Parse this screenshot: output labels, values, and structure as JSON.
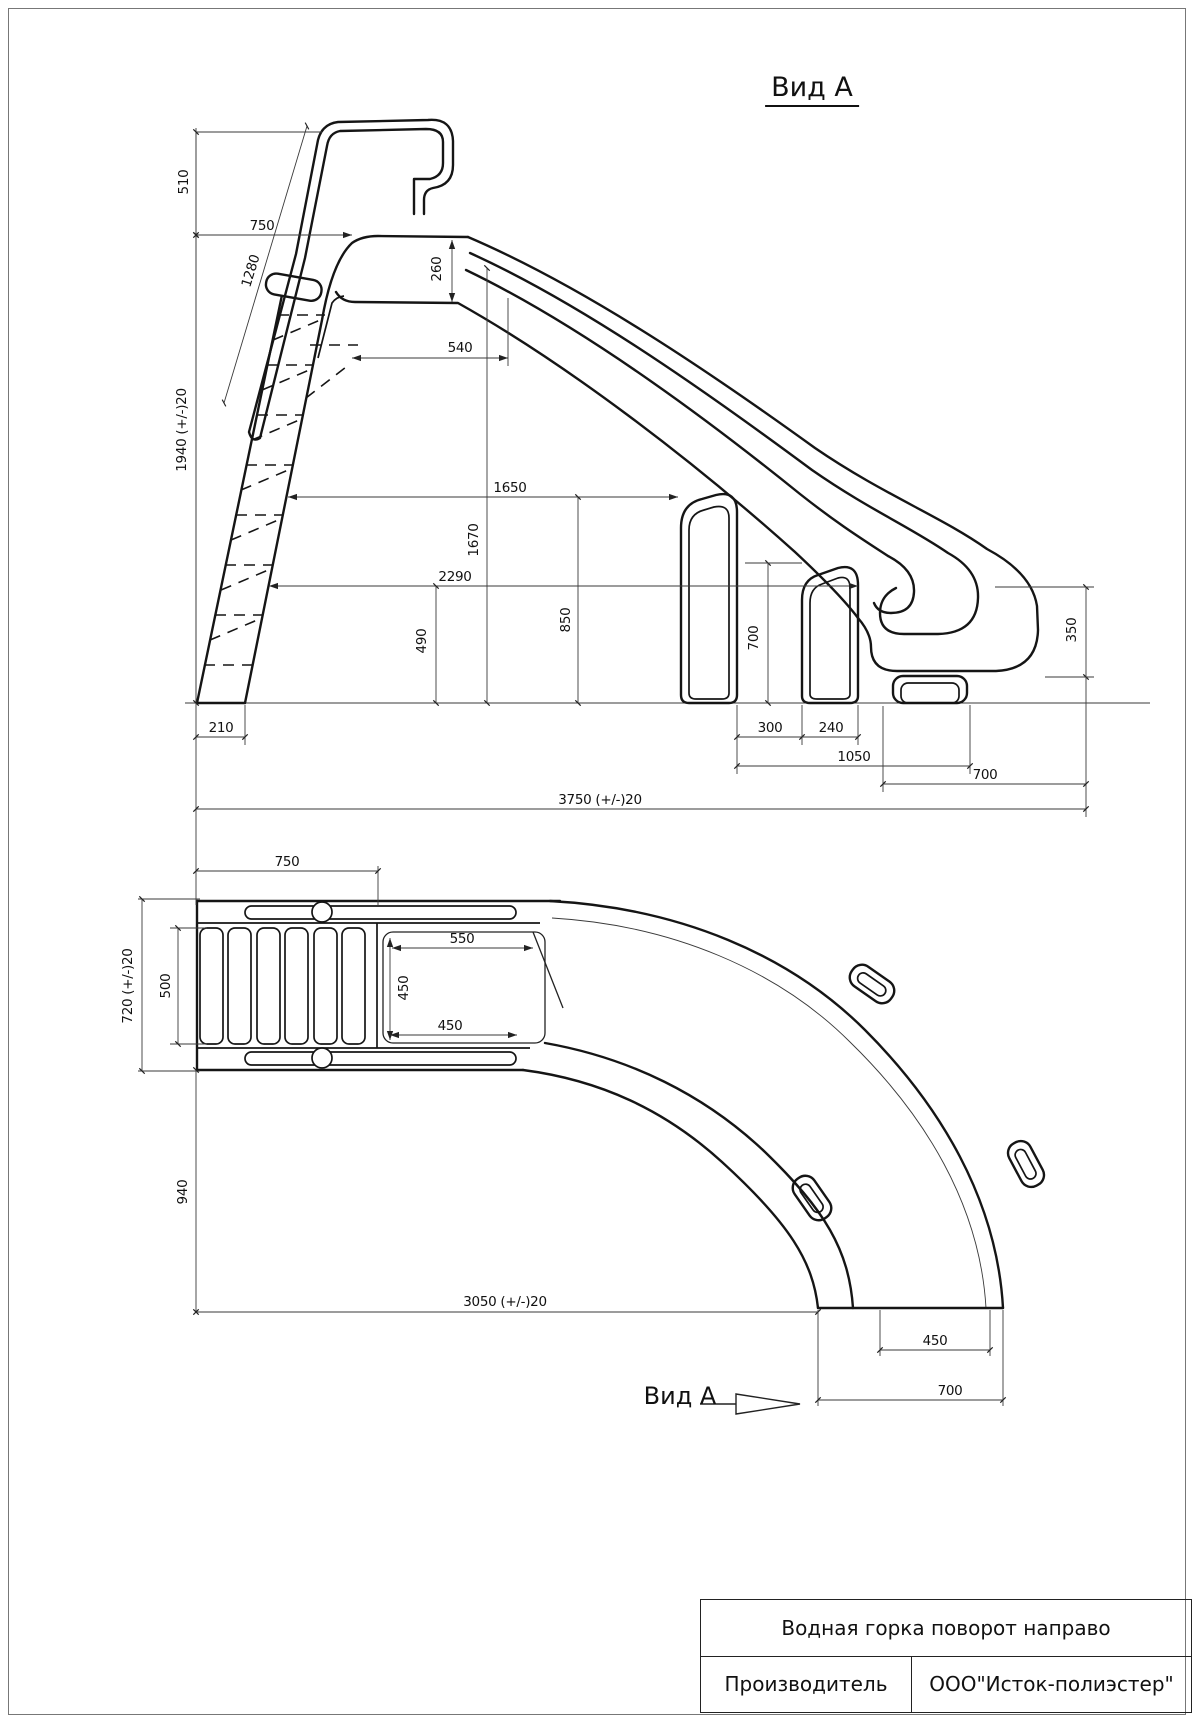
{
  "titles": {
    "view_a_top": "Вид А",
    "view_a_bottom": "Вид А"
  },
  "side_view": {
    "dims": {
      "d510": "510",
      "d750": "750",
      "d1280": "1280",
      "d1940": "1940 (+/-)20",
      "d260": "260",
      "d540": "540",
      "d1650": "1650",
      "d1670": "1670",
      "d2290": "2290",
      "d850": "850",
      "d490": "490",
      "d700_leg": "700",
      "d350": "350",
      "d210": "210",
      "d300": "300",
      "d240": "240",
      "d1050": "1050",
      "d700_bottom": "700",
      "d3750": "3750 (+/-)20"
    }
  },
  "plan_view": {
    "dims": {
      "d750": "750",
      "d720": "720 (+/-)20",
      "d500": "500",
      "d550": "550",
      "d450_v": "450",
      "d450_h": "450",
      "d940": "940",
      "d3050": "3050 (+/-)20",
      "d450_exit": "450",
      "d700_exit": "700"
    }
  },
  "title_block": {
    "product": "Водная горка поворот направо",
    "manufacturer_label": "Производитель",
    "manufacturer_value": "ООО\"Исток-полиэстер\""
  }
}
